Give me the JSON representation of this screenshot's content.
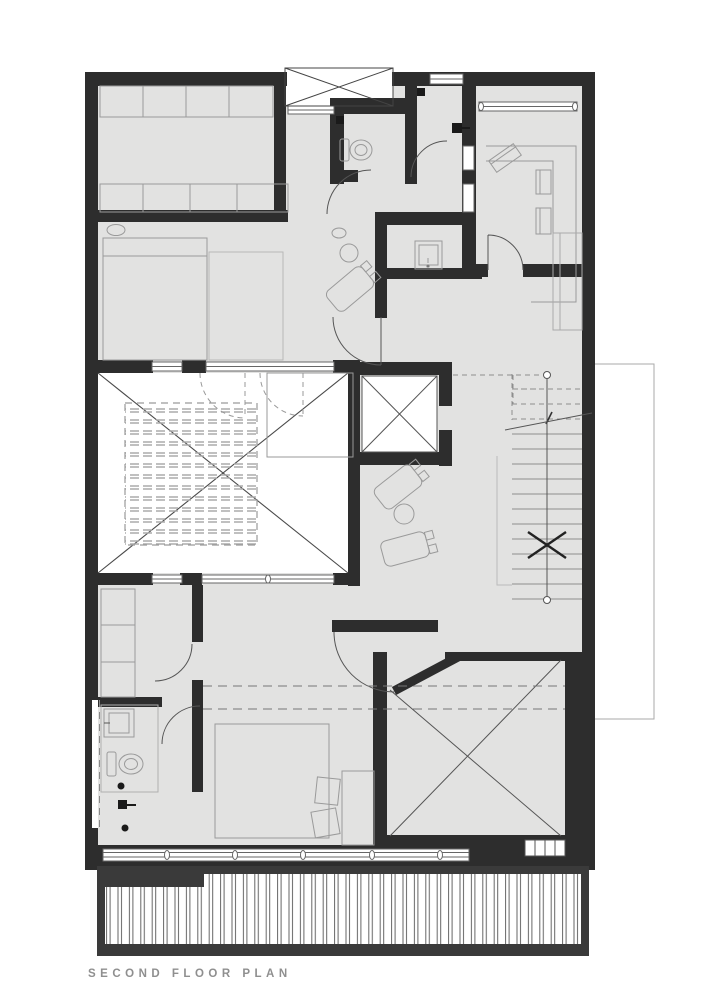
{
  "caption": {
    "title": "SECOND FLOOR PLAN"
  },
  "colors": {
    "wall": "#2d2d2d",
    "floor": "#e2e2e1",
    "thin_line": "#9a9a9a",
    "dark_line": "#555555",
    "caption_text": "#8f8f8f",
    "background": "#ffffff"
  }
}
